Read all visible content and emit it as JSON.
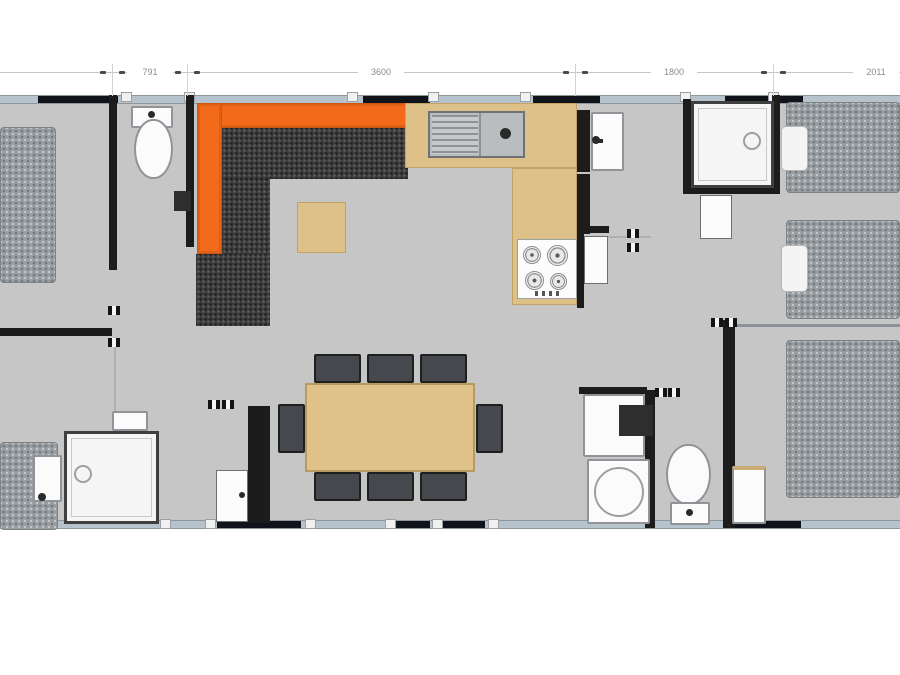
{
  "page": {
    "width": 900,
    "height": 675,
    "background": "#ffffff"
  },
  "colors": {
    "floor": "#c6c6c6",
    "wall": "#1c1c1c",
    "window_band": "#b6c3cc",
    "window_glass": "#10141a",
    "sofa_orange": "#f26a1a",
    "sofa_cushion": "#3c3c3c",
    "wood_tan": "#dec189",
    "bed_gray": "#979da0",
    "fixture_white": "#fbfbfb",
    "dimension_text": "#8c8c8c"
  },
  "dimensions": {
    "labels": [
      "791",
      "3600",
      "1800",
      "2011"
    ],
    "boundaries_px": [
      112,
      187,
      575,
      773
    ]
  },
  "plan": {
    "elements": [
      {
        "n": "floor",
        "c": "floor",
        "x": 0,
        "y": 95,
        "w": 900,
        "h": 434
      },
      {
        "n": "exterior-wall-top",
        "c": "band",
        "x": 0,
        "y": 95,
        "w": 900,
        "h": 9
      },
      {
        "n": "exterior-wall-bottom",
        "c": "band",
        "x": 0,
        "y": 520,
        "w": 900,
        "h": 9
      },
      {
        "n": "window-top-1",
        "c": "win",
        "x": 38,
        "y": 96,
        "w": 80,
        "h": 7
      },
      {
        "n": "window-top-2",
        "c": "win",
        "x": 363,
        "y": 96,
        "w": 67,
        "h": 7
      },
      {
        "n": "window-top-3",
        "c": "win",
        "x": 533,
        "y": 96,
        "w": 67,
        "h": 7
      },
      {
        "n": "window-top-4",
        "c": "win",
        "x": 725,
        "y": 96,
        "w": 78,
        "h": 7
      },
      {
        "n": "window-bottom-1",
        "c": "win",
        "x": 217,
        "y": 521,
        "w": 84,
        "h": 7
      },
      {
        "n": "window-bottom-2",
        "c": "win",
        "x": 393,
        "y": 521,
        "w": 37,
        "h": 7
      },
      {
        "n": "window-bottom-3",
        "c": "win",
        "x": 440,
        "y": 521,
        "w": 45,
        "h": 7
      },
      {
        "n": "window-bottom-4",
        "c": "win",
        "x": 723,
        "y": 521,
        "w": 78,
        "h": 7
      },
      {
        "n": "frame-bracket",
        "c": "bracket",
        "x": 121,
        "y": 92,
        "w": 11,
        "h": 10
      },
      {
        "n": "frame-bracket",
        "c": "bracket",
        "x": 184,
        "y": 92,
        "w": 11,
        "h": 10
      },
      {
        "n": "frame-bracket",
        "c": "bracket",
        "x": 347,
        "y": 92,
        "w": 11,
        "h": 10
      },
      {
        "n": "frame-bracket",
        "c": "bracket",
        "x": 428,
        "y": 92,
        "w": 11,
        "h": 10
      },
      {
        "n": "frame-bracket",
        "c": "bracket",
        "x": 520,
        "y": 92,
        "w": 11,
        "h": 10
      },
      {
        "n": "frame-bracket",
        "c": "bracket",
        "x": 680,
        "y": 92,
        "w": 11,
        "h": 10
      },
      {
        "n": "frame-bracket",
        "c": "bracket",
        "x": 768,
        "y": 92,
        "w": 11,
        "h": 10
      },
      {
        "n": "frame-bracket",
        "c": "bracket",
        "x": 160,
        "y": 519,
        "w": 11,
        "h": 10
      },
      {
        "n": "frame-bracket",
        "c": "bracket",
        "x": 205,
        "y": 519,
        "w": 11,
        "h": 10
      },
      {
        "n": "frame-bracket",
        "c": "bracket",
        "x": 305,
        "y": 519,
        "w": 11,
        "h": 10
      },
      {
        "n": "frame-bracket",
        "c": "bracket",
        "x": 385,
        "y": 519,
        "w": 11,
        "h": 10
      },
      {
        "n": "frame-bracket",
        "c": "bracket",
        "x": 432,
        "y": 519,
        "w": 11,
        "h": 10
      },
      {
        "n": "frame-bracket",
        "c": "bracket",
        "x": 488,
        "y": 519,
        "w": 11,
        "h": 10
      },
      {
        "n": "wall-left-bedroom-vertical",
        "c": "wall",
        "x": 109,
        "y": 95,
        "w": 8,
        "h": 175
      },
      {
        "n": "wall-left-bedroom-horizontal",
        "c": "wall",
        "x": 0,
        "y": 328,
        "w": 112,
        "h": 8
      },
      {
        "n": "wall-wc-right",
        "c": "wall",
        "x": 186,
        "y": 95,
        "w": 8,
        "h": 152
      },
      {
        "n": "wall-kitchen-hall-upper",
        "c": "wall",
        "x": 577,
        "y": 110,
        "w": 13,
        "h": 62
      },
      {
        "n": "wall-kitchen-hall-lower",
        "c": "wall",
        "x": 577,
        "y": 174,
        "w": 13,
        "h": 60
      },
      {
        "n": "wall-kitchen-hall-thin",
        "c": "wall",
        "x": 577,
        "y": 234,
        "w": 7,
        "h": 74
      },
      {
        "n": "wall-hall-stub",
        "c": "wall",
        "x": 577,
        "y": 226,
        "w": 32,
        "h": 7
      },
      {
        "n": "wall-shower-left",
        "c": "wall",
        "x": 683,
        "y": 99,
        "w": 8,
        "h": 95
      },
      {
        "n": "wall-shower-bottom",
        "c": "wall",
        "x": 683,
        "y": 186,
        "w": 96,
        "h": 8
      },
      {
        "n": "wall-shower-right",
        "c": "wall",
        "x": 772,
        "y": 95,
        "w": 8,
        "h": 99
      },
      {
        "n": "wall-bathroom-vertical",
        "c": "wall",
        "x": 645,
        "y": 390,
        "w": 10,
        "h": 138
      },
      {
        "n": "wall-bathroom-horizontal",
        "c": "wall",
        "x": 579,
        "y": 387,
        "w": 68,
        "h": 7
      },
      {
        "n": "wall-right-hall-vertical",
        "c": "wall",
        "x": 723,
        "y": 320,
        "w": 12,
        "h": 208
      },
      {
        "n": "wall-right-bedrooms-divider",
        "c": "wall-med",
        "x": 735,
        "y": 324,
        "w": 165,
        "h": 3
      },
      {
        "n": "wall-entrance-column",
        "c": "wall",
        "x": 248,
        "y": 406,
        "w": 22,
        "h": 117
      },
      {
        "n": "door-swing-line-hall",
        "c": "swing",
        "x": 607,
        "y": 236,
        "w": 44,
        "h": 2
      },
      {
        "n": "door-swing-line-left",
        "c": "swing",
        "x": 114,
        "y": 337,
        "w": 2,
        "h": 90
      },
      {
        "n": "door-swing-line-entry",
        "c": "swing diag",
        "x": 138,
        "y": 477,
        "w": 2,
        "h": 48
      },
      {
        "n": "bed-left-bedroom",
        "c": "bed",
        "x": 0,
        "y": 127,
        "w": 56,
        "h": 156
      },
      {
        "n": "floor-mat-bottom-left",
        "c": "bed",
        "x": 0,
        "y": 442,
        "w": 58,
        "h": 88
      },
      {
        "n": "bed-right-top",
        "c": "bed",
        "x": 786,
        "y": 102,
        "w": 114,
        "h": 91
      },
      {
        "n": "bed-right-middle",
        "c": "bed",
        "x": 786,
        "y": 220,
        "w": 114,
        "h": 99
      },
      {
        "n": "bed-right-bottom",
        "c": "bed",
        "x": 786,
        "y": 340,
        "w": 114,
        "h": 158
      },
      {
        "n": "pillow-top-bed",
        "c": "pillow",
        "x": 781,
        "y": 126,
        "w": 27,
        "h": 45
      },
      {
        "n": "pillow-middle-bed",
        "c": "pillow",
        "x": 781,
        "y": 245,
        "w": 27,
        "h": 47
      },
      {
        "n": "toilet-tank-top-wc",
        "c": "fixture",
        "x": 131,
        "y": 106,
        "w": 42,
        "h": 22
      },
      {
        "n": "toilet-tank-button",
        "c": "dot",
        "x": 148,
        "y": 111,
        "w": 7,
        "h": 7
      },
      {
        "n": "toilet-bowl-top-wc",
        "c": "fixture oval",
        "x": 134,
        "y": 119,
        "w": 39,
        "h": 60
      },
      {
        "n": "tv-unit",
        "c": "cab",
        "x": 174,
        "y": 191,
        "w": 17,
        "h": 20
      },
      {
        "n": "sofa-back-top",
        "c": "orange",
        "x": 197,
        "y": 103,
        "w": 211,
        "h": 25
      },
      {
        "n": "sofa-back-left",
        "c": "orange",
        "x": 197,
        "y": 103,
        "w": 25,
        "h": 151
      },
      {
        "n": "sofa-cushions-top",
        "c": "cushion",
        "x": 222,
        "y": 128,
        "w": 186,
        "h": 51
      },
      {
        "n": "sofa-cushions-left",
        "c": "cushion",
        "x": 222,
        "y": 179,
        "w": 48,
        "h": 77
      },
      {
        "n": "sofa-chaise",
        "c": "cushion",
        "x": 196,
        "y": 254,
        "w": 74,
        "h": 72
      },
      {
        "n": "coffee-table",
        "c": "tan",
        "x": 297,
        "y": 202,
        "w": 49,
        "h": 51
      },
      {
        "n": "kitchen-counter-top",
        "c": "tan",
        "x": 405,
        "y": 103,
        "w": 172,
        "h": 65
      },
      {
        "n": "kitchen-counter-column",
        "c": "tan",
        "x": 512,
        "y": 168,
        "w": 65,
        "h": 137
      },
      {
        "n": "kitchen-sink-unit",
        "c": "sink",
        "x": 428,
        "y": 111,
        "w": 97,
        "h": 47
      },
      {
        "n": "sink-drainboard",
        "c": "sink-lines",
        "x": 432,
        "y": 115,
        "w": 46,
        "h": 39
      },
      {
        "n": "sink-divider",
        "c": "divider",
        "x": 479,
        "y": 113,
        "w": 2,
        "h": 43
      },
      {
        "n": "sink-drain",
        "c": "dot",
        "x": 500,
        "y": 128,
        "w": 11,
        "h": 11
      },
      {
        "n": "cooktop",
        "c": "hob",
        "x": 517,
        "y": 239,
        "w": 60,
        "h": 60
      },
      {
        "n": "burner",
        "c": "burner",
        "x": 523,
        "y": 246,
        "w": 18,
        "h": 18
      },
      {
        "n": "burner",
        "c": "burner",
        "x": 547,
        "y": 245,
        "w": 21,
        "h": 21
      },
      {
        "n": "burner",
        "c": "burner",
        "x": 525,
        "y": 271,
        "w": 19,
        "h": 19
      },
      {
        "n": "burner",
        "c": "burner",
        "x": 550,
        "y": 273,
        "w": 17,
        "h": 17
      },
      {
        "n": "cooktop-knobs",
        "c": "knobs",
        "x": 535,
        "y": 291,
        "w": 28,
        "h": 5
      },
      {
        "n": "hall-washbasin",
        "c": "fixture",
        "x": 591,
        "y": 112,
        "w": 33,
        "h": 59
      },
      {
        "n": "hall-washbasin-tap-stem",
        "c": "stem",
        "x": 593,
        "y": 139,
        "w": 10,
        "h": 4
      },
      {
        "n": "hall-washbasin-tap",
        "c": "dot",
        "x": 592,
        "y": 136,
        "w": 8,
        "h": 8
      },
      {
        "n": "hall-door-panel",
        "c": "door",
        "x": 584,
        "y": 236,
        "w": 24,
        "h": 48
      },
      {
        "n": "shower-tray-top-right",
        "c": "shower",
        "x": 691,
        "y": 101,
        "w": 83,
        "h": 87
      },
      {
        "n": "shower-tray-top-right-inner",
        "c": "inner",
        "x": 698,
        "y": 108,
        "w": 69,
        "h": 73
      },
      {
        "n": "shower-drain-top-right",
        "c": "ring",
        "x": 743,
        "y": 132,
        "w": 18,
        "h": 18
      },
      {
        "n": "shower-door-panel",
        "c": "door",
        "x": 700,
        "y": 195,
        "w": 32,
        "h": 44
      },
      {
        "n": "dining-table",
        "c": "table",
        "x": 305,
        "y": 383,
        "w": 170,
        "h": 89
      },
      {
        "n": "dining-chair",
        "c": "chair",
        "x": 314,
        "y": 354,
        "w": 47,
        "h": 29
      },
      {
        "n": "dining-chair",
        "c": "chair",
        "x": 367,
        "y": 354,
        "w": 47,
        "h": 29
      },
      {
        "n": "dining-chair",
        "c": "chair",
        "x": 420,
        "y": 354,
        "w": 47,
        "h": 29
      },
      {
        "n": "dining-chair",
        "c": "chair",
        "x": 314,
        "y": 472,
        "w": 47,
        "h": 29
      },
      {
        "n": "dining-chair",
        "c": "chair",
        "x": 367,
        "y": 472,
        "w": 47,
        "h": 29
      },
      {
        "n": "dining-chair",
        "c": "chair",
        "x": 420,
        "y": 472,
        "w": 47,
        "h": 29
      },
      {
        "n": "dining-chair",
        "c": "chair",
        "x": 278,
        "y": 404,
        "w": 27,
        "h": 49
      },
      {
        "n": "dining-chair",
        "c": "chair",
        "x": 476,
        "y": 404,
        "w": 27,
        "h": 49
      },
      {
        "n": "bathroom-vanity",
        "c": "fixture",
        "x": 583,
        "y": 394,
        "w": 62,
        "h": 63
      },
      {
        "n": "bathroom-stool",
        "c": "cab",
        "x": 619,
        "y": 405,
        "w": 34,
        "h": 31
      },
      {
        "n": "bathroom-round-sink-unit",
        "c": "fixture",
        "x": 587,
        "y": 459,
        "w": 63,
        "h": 65
      },
      {
        "n": "bathroom-round-sink",
        "c": "ring",
        "x": 594,
        "y": 467,
        "w": 50,
        "h": 50
      },
      {
        "n": "toilet-bowl-bathroom",
        "c": "fixture oval",
        "x": 666,
        "y": 444,
        "w": 45,
        "h": 61
      },
      {
        "n": "toilet-base-bathroom",
        "c": "fixture",
        "x": 670,
        "y": 502,
        "w": 40,
        "h": 23
      },
      {
        "n": "toilet-base-button",
        "c": "dot",
        "x": 686,
        "y": 509,
        "w": 7,
        "h": 7
      },
      {
        "n": "nightstand",
        "c": "fixture tan-top",
        "x": 732,
        "y": 466,
        "w": 34,
        "h": 58
      },
      {
        "n": "shower-tray-bottom-left",
        "c": "shower",
        "x": 64,
        "y": 431,
        "w": 95,
        "h": 93
      },
      {
        "n": "shower-tray-bottom-left-inner",
        "c": "inner",
        "x": 71,
        "y": 438,
        "w": 81,
        "h": 79
      },
      {
        "n": "shower-drain-bottom-left",
        "c": "ring",
        "x": 74,
        "y": 465,
        "w": 18,
        "h": 18
      },
      {
        "n": "shower-step",
        "c": "fixture",
        "x": 112,
        "y": 411,
        "w": 36,
        "h": 20
      },
      {
        "n": "washbasin-bottom-left",
        "c": "fixture",
        "x": 33,
        "y": 455,
        "w": 29,
        "h": 47
      },
      {
        "n": "washbasin-bottom-left-tap",
        "c": "dot",
        "x": 38,
        "y": 493,
        "w": 8,
        "h": 8
      },
      {
        "n": "entrance-door-panel",
        "c": "door",
        "x": 216,
        "y": 470,
        "w": 32,
        "h": 52
      },
      {
        "n": "entrance-door-handle",
        "c": "dot",
        "x": 239,
        "y": 492,
        "w": 6,
        "h": 6
      },
      {
        "n": "door-hinge",
        "c": "hinge",
        "x": 108,
        "y": 306,
        "w": 12,
        "h": 9
      },
      {
        "n": "door-hinge",
        "c": "hinge",
        "x": 108,
        "y": 338,
        "w": 12,
        "h": 9
      },
      {
        "n": "door-hinge",
        "c": "hinge",
        "x": 208,
        "y": 400,
        "w": 12,
        "h": 9
      },
      {
        "n": "door-hinge",
        "c": "hinge",
        "x": 222,
        "y": 400,
        "w": 12,
        "h": 9
      },
      {
        "n": "door-hinge",
        "c": "hinge",
        "x": 627,
        "y": 229,
        "w": 12,
        "h": 9
      },
      {
        "n": "door-hinge",
        "c": "hinge",
        "x": 627,
        "y": 243,
        "w": 12,
        "h": 9
      },
      {
        "n": "door-hinge",
        "c": "hinge",
        "x": 655,
        "y": 388,
        "w": 12,
        "h": 9
      },
      {
        "n": "door-hinge",
        "c": "hinge",
        "x": 668,
        "y": 388,
        "w": 12,
        "h": 9
      },
      {
        "n": "door-hinge",
        "c": "hinge",
        "x": 711,
        "y": 318,
        "w": 12,
        "h": 9
      },
      {
        "n": "door-hinge",
        "c": "hinge",
        "x": 725,
        "y": 318,
        "w": 12,
        "h": 9
      },
      {
        "n": "dimension-line",
        "c": "dimline",
        "x": 0,
        "y": 72,
        "w": 900,
        "h": 1
      },
      {
        "n": "dimension-extension",
        "c": "dimtick",
        "x": 112,
        "y": 64,
        "w": 1,
        "h": 32
      },
      {
        "n": "dimension-extension",
        "c": "dimtick",
        "x": 187,
        "y": 64,
        "w": 1,
        "h": 32
      },
      {
        "n": "dimension-extension",
        "c": "dimtick",
        "x": 575,
        "y": 64,
        "w": 1,
        "h": 32
      },
      {
        "n": "dimension-extension",
        "c": "dimtick",
        "x": 773,
        "y": 64,
        "w": 1,
        "h": 32
      },
      {
        "n": "dimension-arrow",
        "c": "arrow",
        "x": 100,
        "y": 71,
        "w": 6,
        "h": 3
      },
      {
        "n": "dimension-arrow",
        "c": "arrow",
        "x": 119,
        "y": 71,
        "w": 6,
        "h": 3
      },
      {
        "n": "dimension-arrow",
        "c": "arrow",
        "x": 175,
        "y": 71,
        "w": 6,
        "h": 3
      },
      {
        "n": "dimension-arrow",
        "c": "arrow",
        "x": 194,
        "y": 71,
        "w": 6,
        "h": 3
      },
      {
        "n": "dimension-arrow",
        "c": "arrow",
        "x": 563,
        "y": 71,
        "w": 6,
        "h": 3
      },
      {
        "n": "dimension-arrow",
        "c": "arrow",
        "x": 582,
        "y": 71,
        "w": 6,
        "h": 3
      },
      {
        "n": "dimension-arrow",
        "c": "arrow",
        "x": 761,
        "y": 71,
        "w": 6,
        "h": 3
      },
      {
        "n": "dimension-arrow",
        "c": "arrow",
        "x": 780,
        "y": 71,
        "w": 6,
        "h": 3
      },
      {
        "n": "dimension-label-791",
        "c": "dimlabel",
        "x": 127,
        "y": 66,
        "w": 46,
        "h": 12,
        "text": "791"
      },
      {
        "n": "dimension-label-3600",
        "c": "dimlabel",
        "x": 358,
        "y": 66,
        "w": 46,
        "h": 12,
        "text": "3600"
      },
      {
        "n": "dimension-label-1800",
        "c": "dimlabel",
        "x": 651,
        "y": 66,
        "w": 46,
        "h": 12,
        "text": "1800"
      },
      {
        "n": "dimension-label-2011",
        "c": "dimlabel",
        "x": 853,
        "y": 66,
        "w": 46,
        "h": 12,
        "text": "2011"
      }
    ]
  }
}
